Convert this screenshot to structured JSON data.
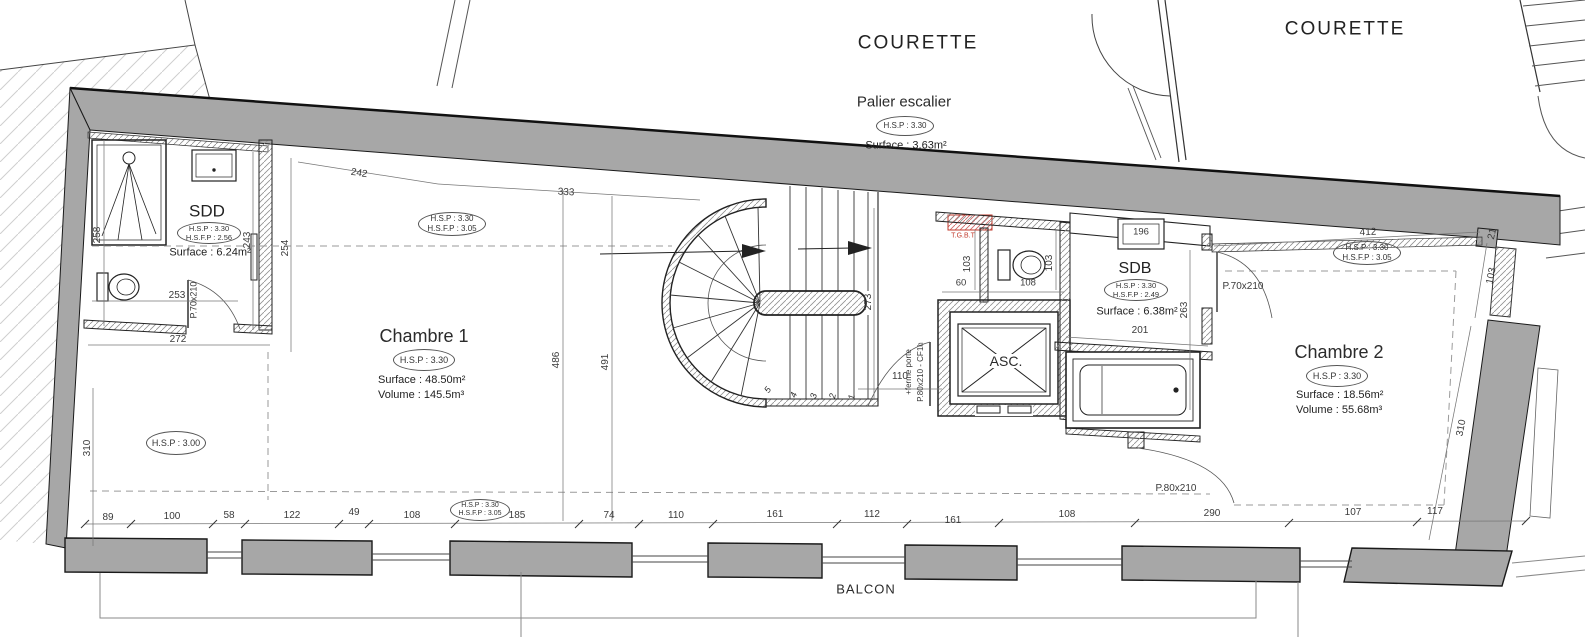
{
  "labels": {
    "courette_left": "COURETTE",
    "courette_right": "COURETTE",
    "balcon": "BALCON",
    "tgbt": "T.G.B.T",
    "asc": "ASC."
  },
  "rooms": {
    "palier": {
      "name": "Palier escalier",
      "hsp": "H.S.P : 3.30",
      "surface": "Surface : 3.63m²"
    },
    "sdd": {
      "name": "SDD",
      "hsp": "H.S.P : 3.30",
      "hsfp": "H.S.F.P : 2.56",
      "surface": "Surface : 6.24m²"
    },
    "chambre1": {
      "name": "Chambre 1",
      "hsp": "H.S.P : 3.30",
      "surface": "Surface : 48.50m²",
      "volume": "Volume : 145.5m³"
    },
    "sdb": {
      "name": "SDB",
      "hsp": "H.S.P : 3.30",
      "hsfp": "H.S.F.P : 2.49",
      "surface": "Surface : 6.38m²"
    },
    "chambre2": {
      "name": "Chambre 2",
      "hsp": "H.S.P : 3.30",
      "surface": "Surface : 18.56m²",
      "volume": "Volume : 55.68m³"
    }
  },
  "ceiling_ovals": {
    "ch1_top": {
      "l1": "H.S.P : 3.30",
      "l2": "H.S.F.P : 3.05"
    },
    "hsp300": {
      "l1": "H.S.P : 3.00"
    },
    "bottom": {
      "l1": "H.S.P : 3.30",
      "l2": "H.S.F.P : 3.05"
    },
    "ch2_top": {
      "l1": "H.S.P : 3.30",
      "l2": "H.S.F.P : 3.05"
    }
  },
  "doors": {
    "sdd": "P.70x210",
    "sdb": "P.70x210",
    "palier_line1": "P.80x210 - CF1h",
    "palier_line2": "+ferme porte",
    "ch2": "P.80x210"
  },
  "dims": {
    "bottom": [
      "89",
      "100",
      "58",
      "122",
      "49",
      "108",
      "185",
      "74",
      "110",
      "161",
      "112",
      "161",
      "108",
      "290",
      "107",
      "117"
    ],
    "d242": "242",
    "d333": "333",
    "d412": "412",
    "d21": "21",
    "d258": "258",
    "d243": "243",
    "d254": "254",
    "d253": "253",
    "d272": "272",
    "d310l": "310",
    "d486": "486",
    "d491": "491",
    "d273": "273",
    "d103a": "103",
    "d60": "60",
    "d108": "108",
    "d103b": "103",
    "d110": "110",
    "d196": "196",
    "d263": "263",
    "d201": "201",
    "d103r": "103",
    "d310r": "310"
  },
  "stair": {
    "treads": [
      "1",
      "2",
      "3",
      "4",
      "5"
    ]
  }
}
